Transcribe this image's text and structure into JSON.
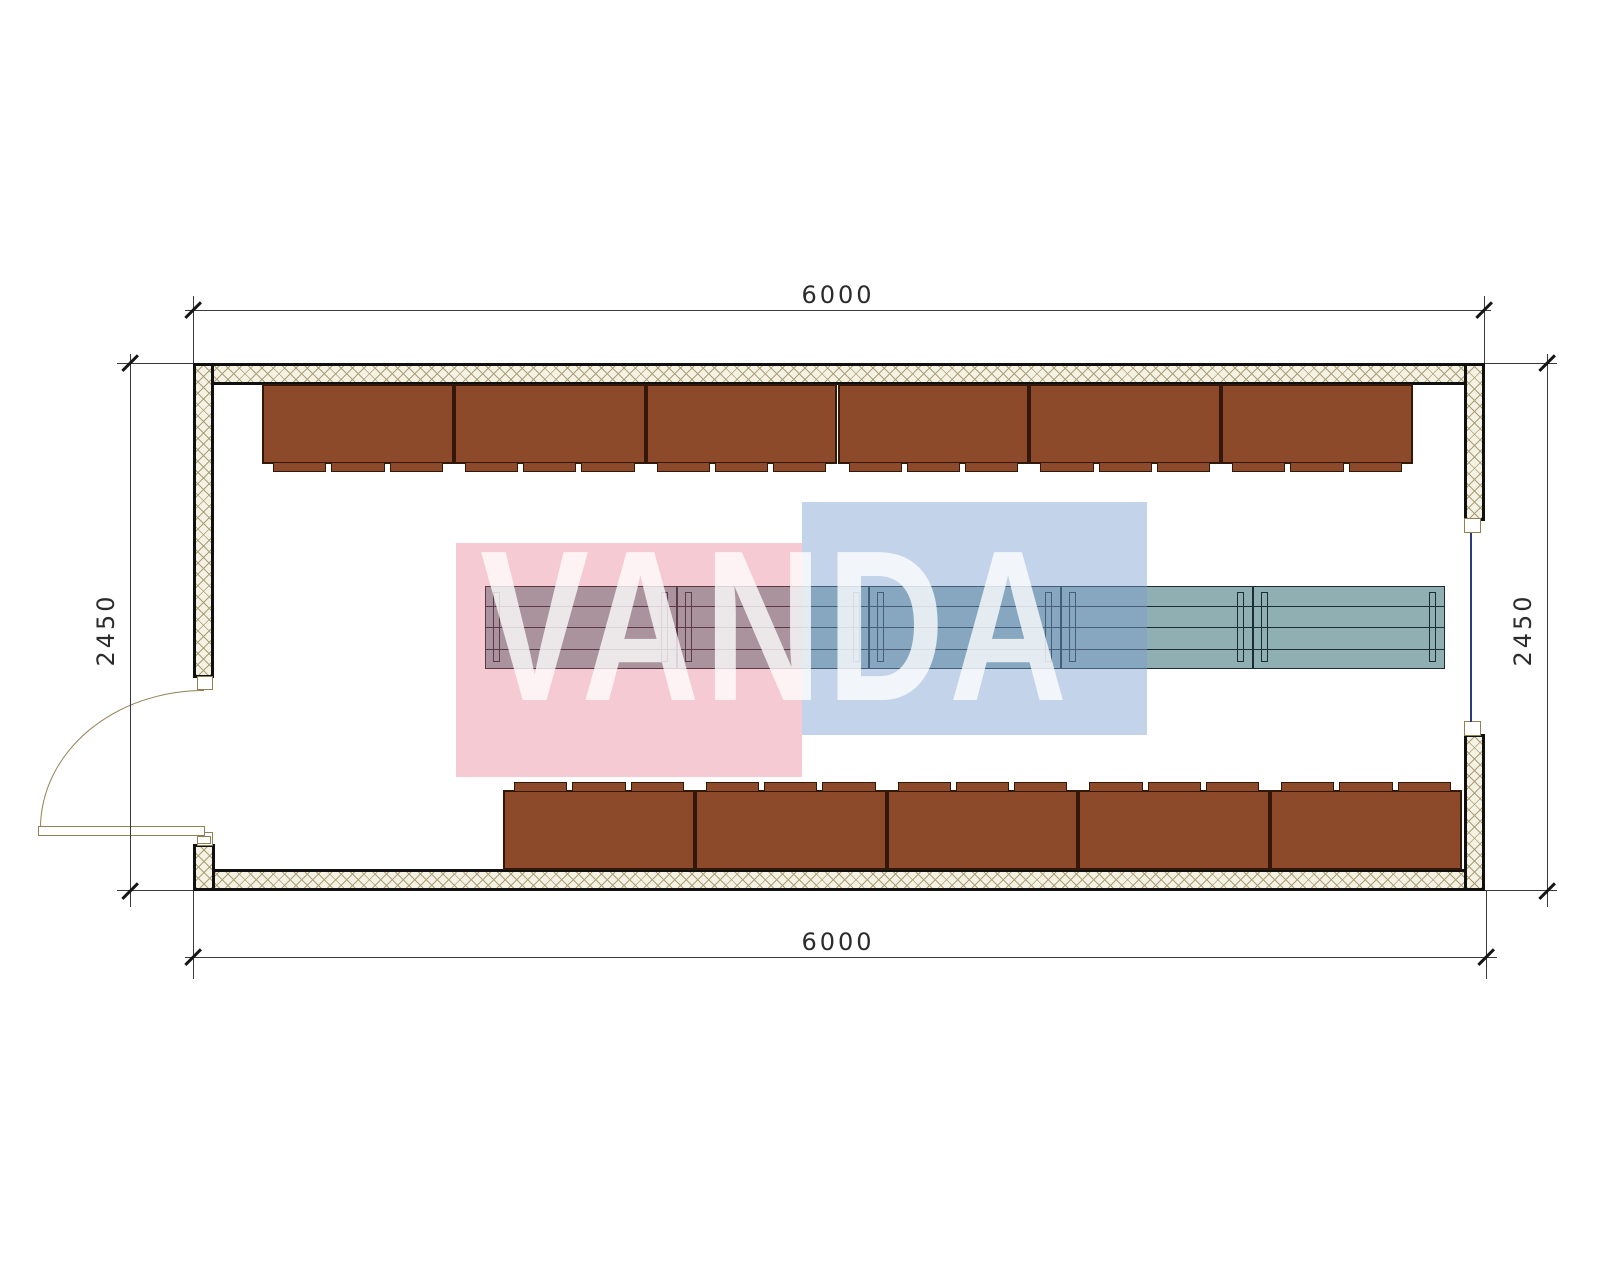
{
  "drawing": {
    "type": "floor-plan",
    "subject": "rectangular cabin plan with wall benches, center tables, door and window"
  },
  "watermark": {
    "text": "VANDA"
  },
  "dimensions": {
    "top": "6000",
    "bottom": "6000",
    "left": "2450",
    "right": "2450"
  },
  "layout": {
    "top_bench_count": 6,
    "bottom_bench_count": 5,
    "table_unit_count": 5,
    "seats_per_bench": 3
  },
  "colors": {
    "bench": "#8C4A2B",
    "bench-outline": "#33180A",
    "table": "#90AFB2",
    "table-outline": "#1C2C34",
    "wall-hatch": "#A89F78",
    "wall-fill": "#F5F1E3",
    "wall-outline": "#101010",
    "door": "#8F8055",
    "window": "#2F3A7D",
    "dimension": "#2B2B2B",
    "watermark-pink": "rgba(226,90,114,0.32)",
    "watermark-blue": "rgba(122,158,206,0.45)"
  }
}
